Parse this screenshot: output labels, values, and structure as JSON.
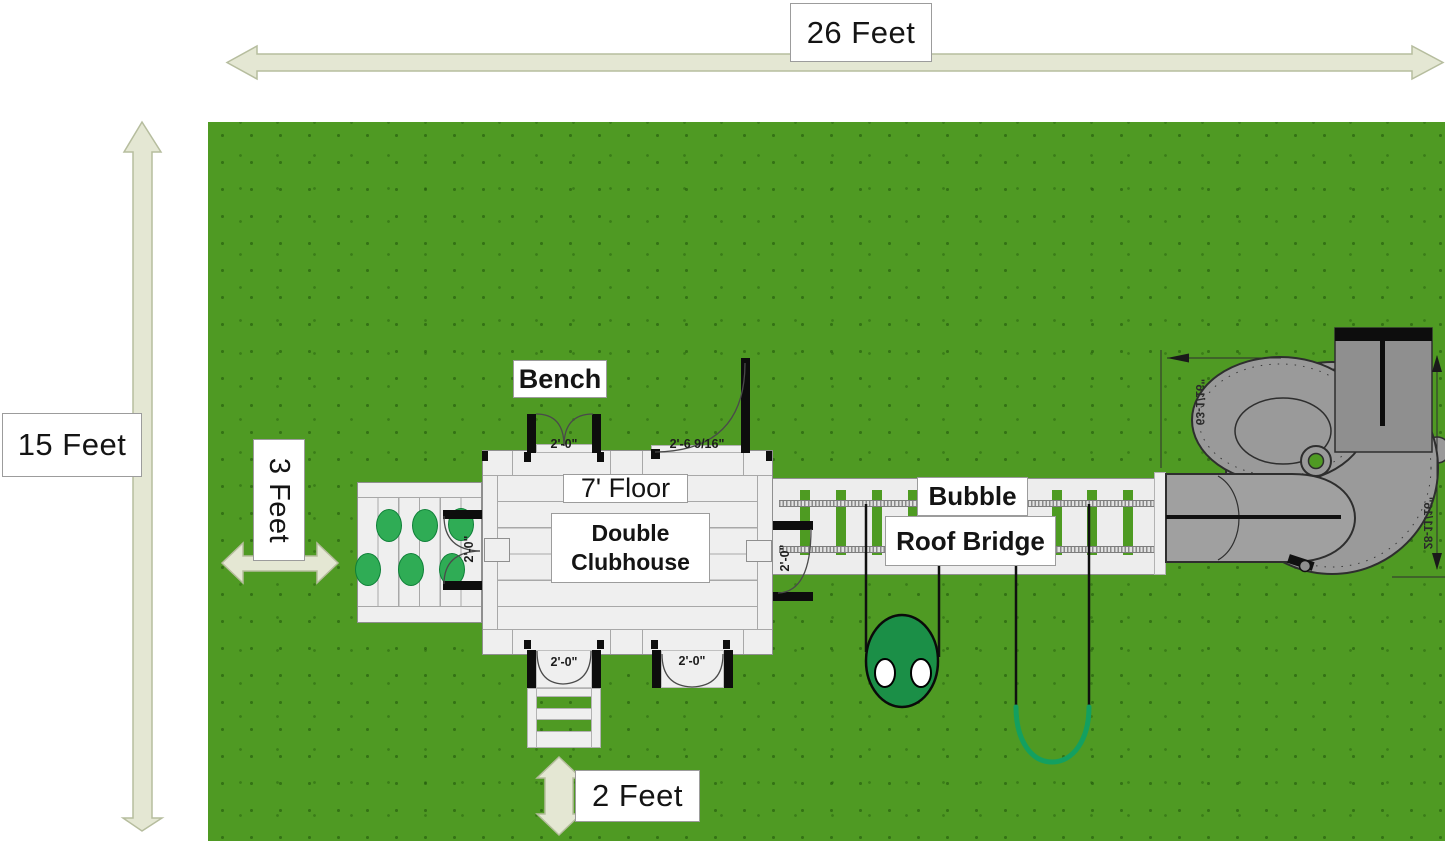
{
  "scene": {
    "type": "playset top-view installation plan"
  },
  "dimensions": {
    "width_label": "26 Feet",
    "height_label": "15 Feet",
    "side_clearance_label": "3 Feet",
    "bottom_clearance_label": "2 Feet"
  },
  "labels": {
    "bench": "Bench",
    "floor": "7' Floor",
    "clubhouse": "Double Clubhouse",
    "bridge_top": "Bubble",
    "bridge_bottom": "Roof Bridge"
  },
  "measurements": {
    "bench_door": "2'-0\"",
    "playhouse_door": "2'-6 9/16\"",
    "climb_wall_door": "2'-0\"",
    "bridge_side_door": "2'-0\"",
    "ladder_door": "2'-0\"",
    "bottom_door": "2'-0\"",
    "slide_width": "63-1/16\"",
    "slide_depth": "28-11/16\""
  },
  "colors": {
    "grass": "#4f9a23",
    "deck": "#efefef",
    "dimension_arrow": "#e4e7d3",
    "climb_hold": "#2fac55",
    "bubble_swing": "#1b8f47",
    "belt_swing": "#13a060",
    "slide": "#9a9a9a"
  }
}
